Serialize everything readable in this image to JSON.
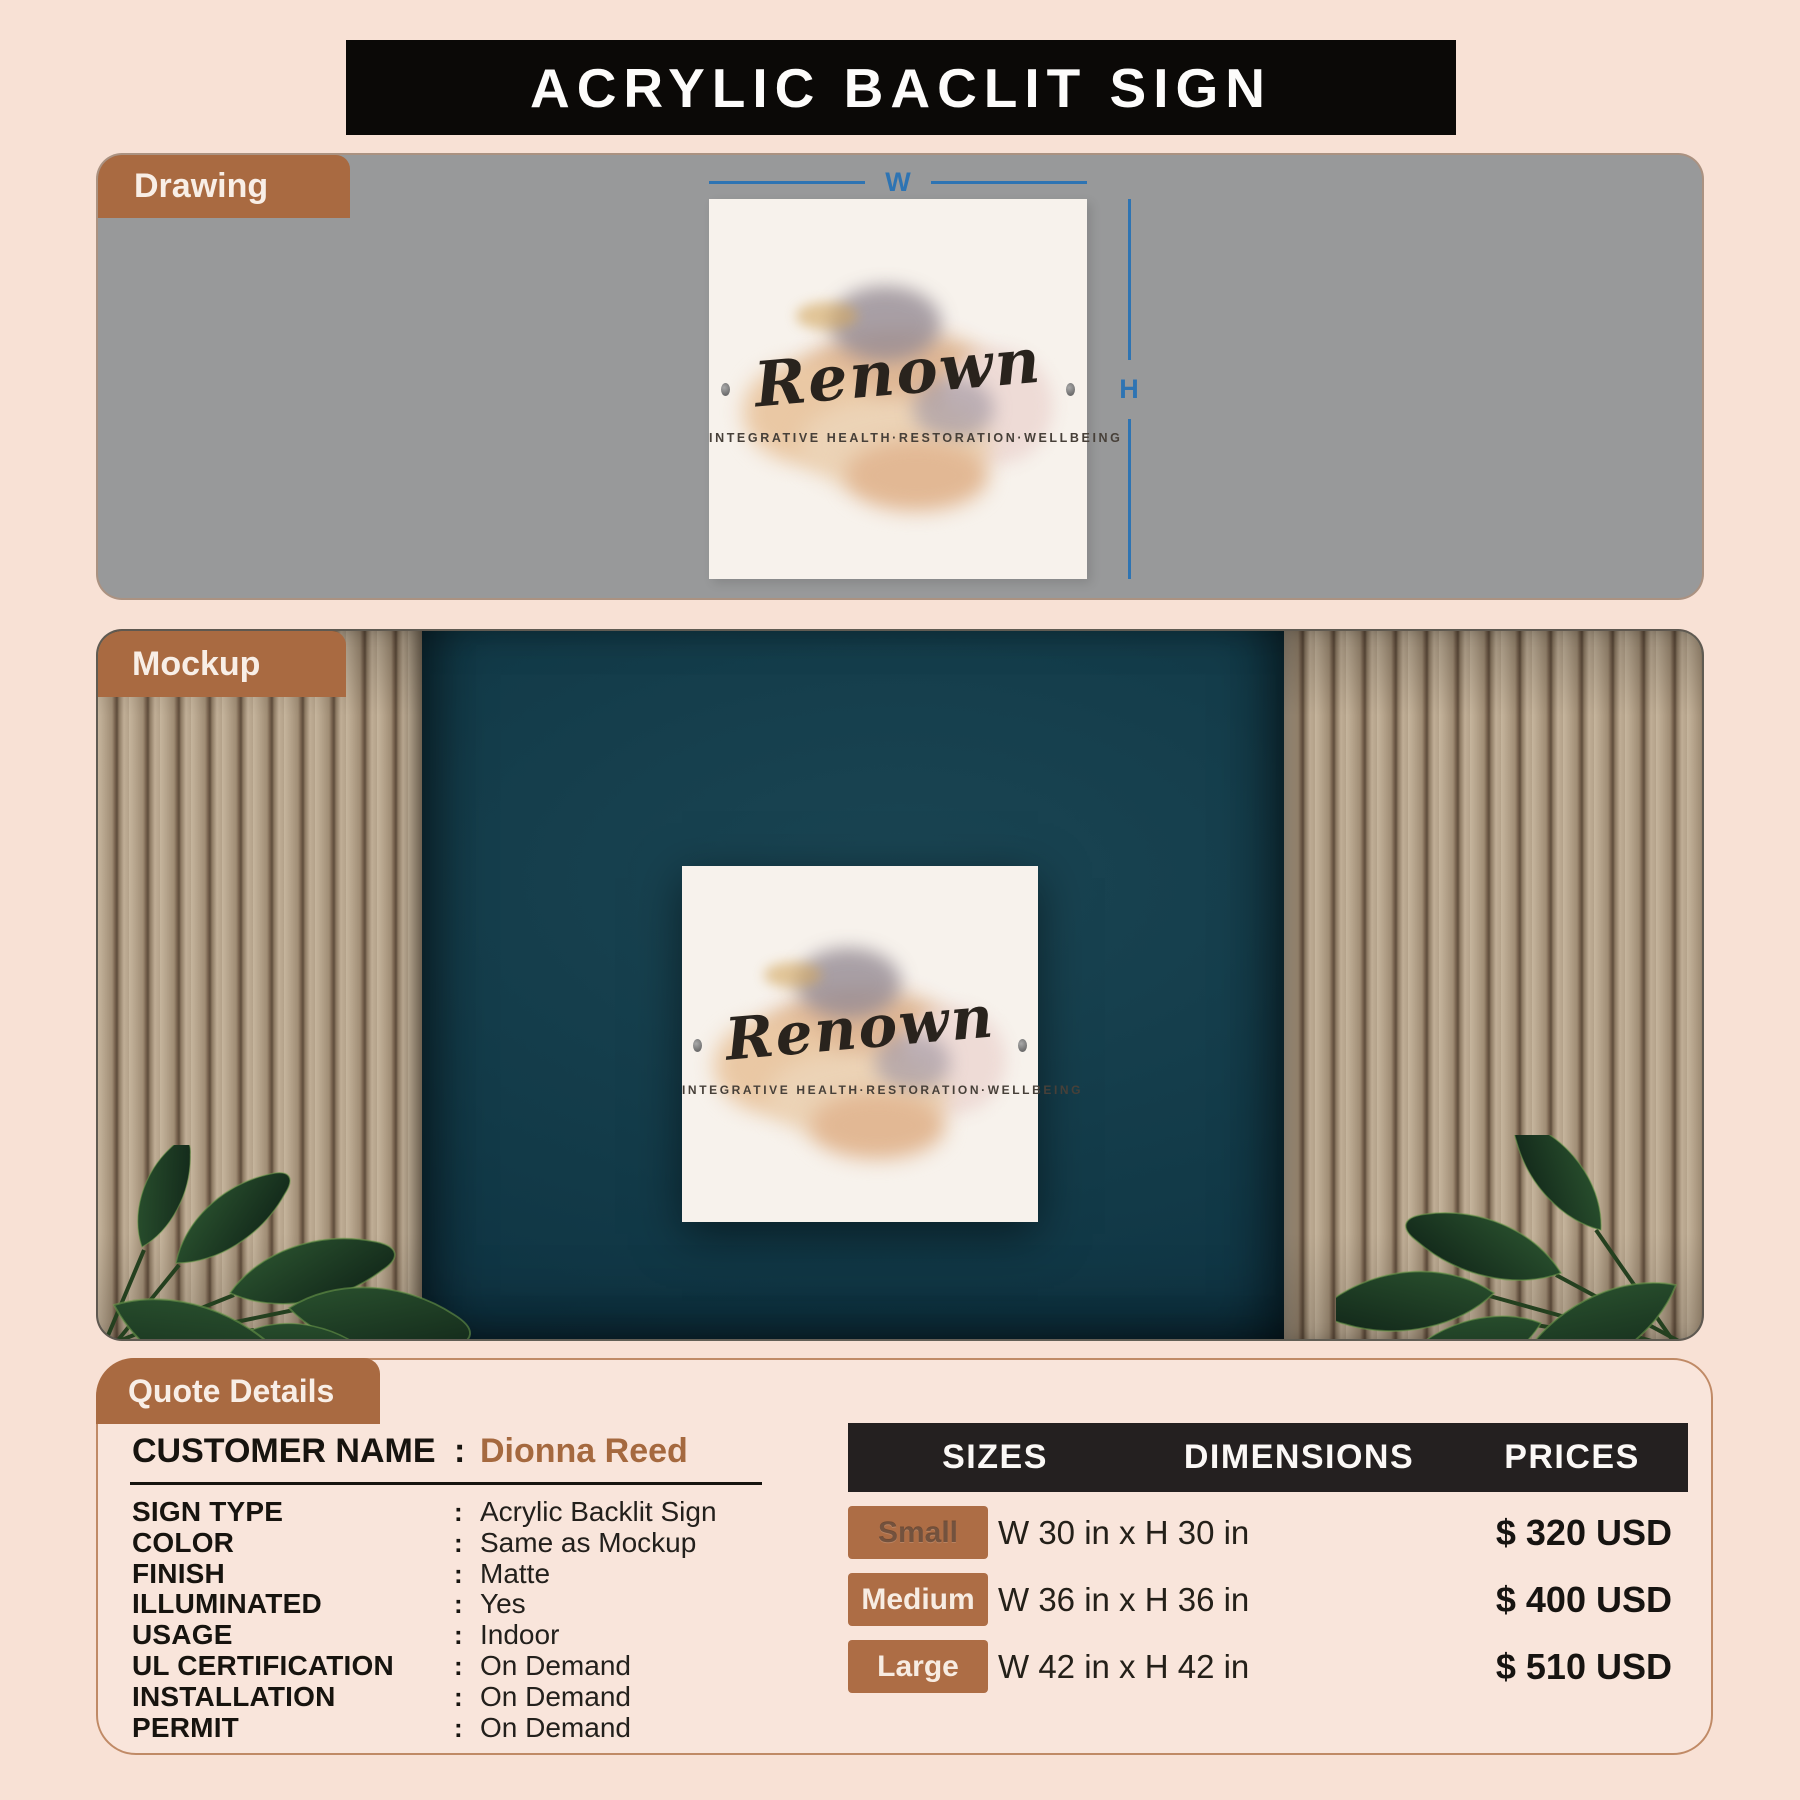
{
  "page": {
    "title": "ACRYLIC BACLIT SIGN"
  },
  "sections": {
    "drawing": {
      "label": "Drawing"
    },
    "mockup": {
      "label": "Mockup"
    },
    "quote": {
      "label": "Quote Details"
    }
  },
  "sign": {
    "brand": "Renown",
    "tagline": "INTEGRATIVE HEALTH·RESTORATION·WELLBEING"
  },
  "dimensions": {
    "width_label": "W",
    "height_label": "H"
  },
  "quote": {
    "colon": ":",
    "customer": {
      "label": "CUSTOMER NAME",
      "value": "Dionna Reed"
    },
    "rows": [
      {
        "label": "SIGN TYPE",
        "value": "Acrylic Backlit Sign"
      },
      {
        "label": "COLOR",
        "value": "Same as Mockup"
      },
      {
        "label": "FINISH",
        "value": "Matte"
      },
      {
        "label": "ILLUMINATED",
        "value": "Yes"
      },
      {
        "label": "USAGE",
        "value": "Indoor"
      },
      {
        "label": "UL CERTIFICATION",
        "value": "On Demand"
      },
      {
        "label": "INSTALLATION",
        "value": "On Demand"
      },
      {
        "label": "PERMIT",
        "value": "On Demand"
      }
    ]
  },
  "pricing": {
    "headers": [
      "SIZES",
      "DIMENSIONS",
      "PRICES"
    ],
    "rows": [
      {
        "size": "Small",
        "dimensions": "W 30 in x H 30 in",
        "price": "$ 320 USD"
      },
      {
        "size": "Medium",
        "dimensions": "W 36 in x H 36 in",
        "price": "$ 400 USD"
      },
      {
        "size": "Large",
        "dimensions": "W 42 in x H 42 in",
        "price": "$ 510 USD"
      }
    ]
  },
  "colors": {
    "accent_brown": "#a96a41",
    "panel_gray": "#98999a",
    "wall_teal": "#0f323f",
    "dimension_blue": "#2e74b3",
    "bar_black": "#0b0907",
    "page_bg": "#f8e1d5"
  }
}
